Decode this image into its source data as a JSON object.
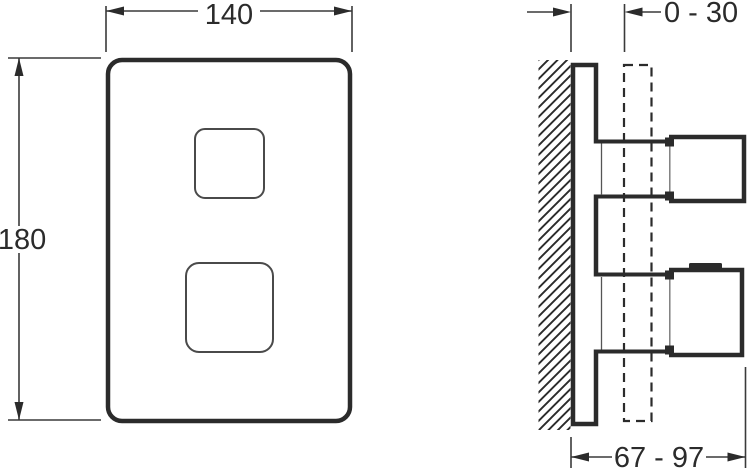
{
  "meta": {
    "background_color": "#ffffff",
    "line_color": "#2b2b2b",
    "thin_line_color": "#777777"
  },
  "front_view": {
    "width_dimension": {
      "label": "140",
      "value_mm": 140
    },
    "height_dimension": {
      "label": "180",
      "value_mm": 180
    }
  },
  "side_view": {
    "plate_offset_dimension": {
      "label": "0 - 30",
      "min_mm": 0,
      "max_mm": 30
    },
    "handle_projection_dimension": {
      "label": "67 - 97",
      "min_mm": 67,
      "max_mm": 97
    }
  }
}
